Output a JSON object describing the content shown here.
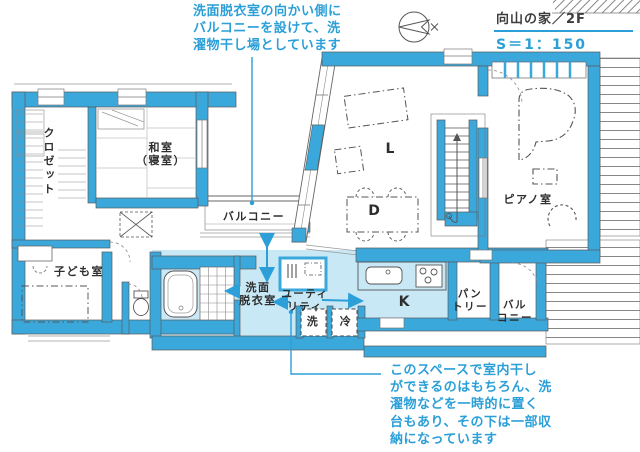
{
  "header": {
    "project_title": "向山の家／2F",
    "scale": "S＝1：150"
  },
  "annotations": {
    "balcony_note": {
      "text": "洗面脱衣室の向かい側にバルコニーを設けて、洗濯物干し場としています",
      "lines": [
        "洗面脱衣室の向かい側に",
        "バルコニーを設けて、洗",
        "濯物干し場としています"
      ]
    },
    "laundry_note": {
      "text": "このスペースで室内干しができるのはもちろん、洗濯物などを一時的に置く台もあり、その下は一部収納になっています",
      "lines": [
        "このスペースで室内干し",
        "ができるのはもちろん、洗",
        "濯物などを一時的に置く",
        "台もあり、その下は一部収",
        "納になっています"
      ]
    }
  },
  "rooms": {
    "closet": "クロゼット",
    "tatami_line1": "和室",
    "tatami_line2": "（寝室）",
    "balcony_left": "バルコニー",
    "kids": "子ども室",
    "washroom_line1": "洗面",
    "washroom_line2": "脱衣室",
    "utility_line1": "ユーティ",
    "utility_line2": "リティ",
    "washer": "洗",
    "fridge": "冷",
    "living": "L",
    "dining": "D",
    "kitchen": "K",
    "piano": "ピアノ室",
    "pantry_line1": "パン",
    "pantry_line2": "トリー",
    "balcony_right_line1": "バル",
    "balcony_right_line2": "コニー"
  },
  "icons": {
    "compass": "north-arrow"
  },
  "colors": {
    "wall_blue": "#3AA8DB",
    "highlight_blue": "#C9E8F6",
    "annotation_blue": "#2B9FD8",
    "label_dark": "#2e2e2e",
    "line_gray": "#5a5a5a"
  }
}
